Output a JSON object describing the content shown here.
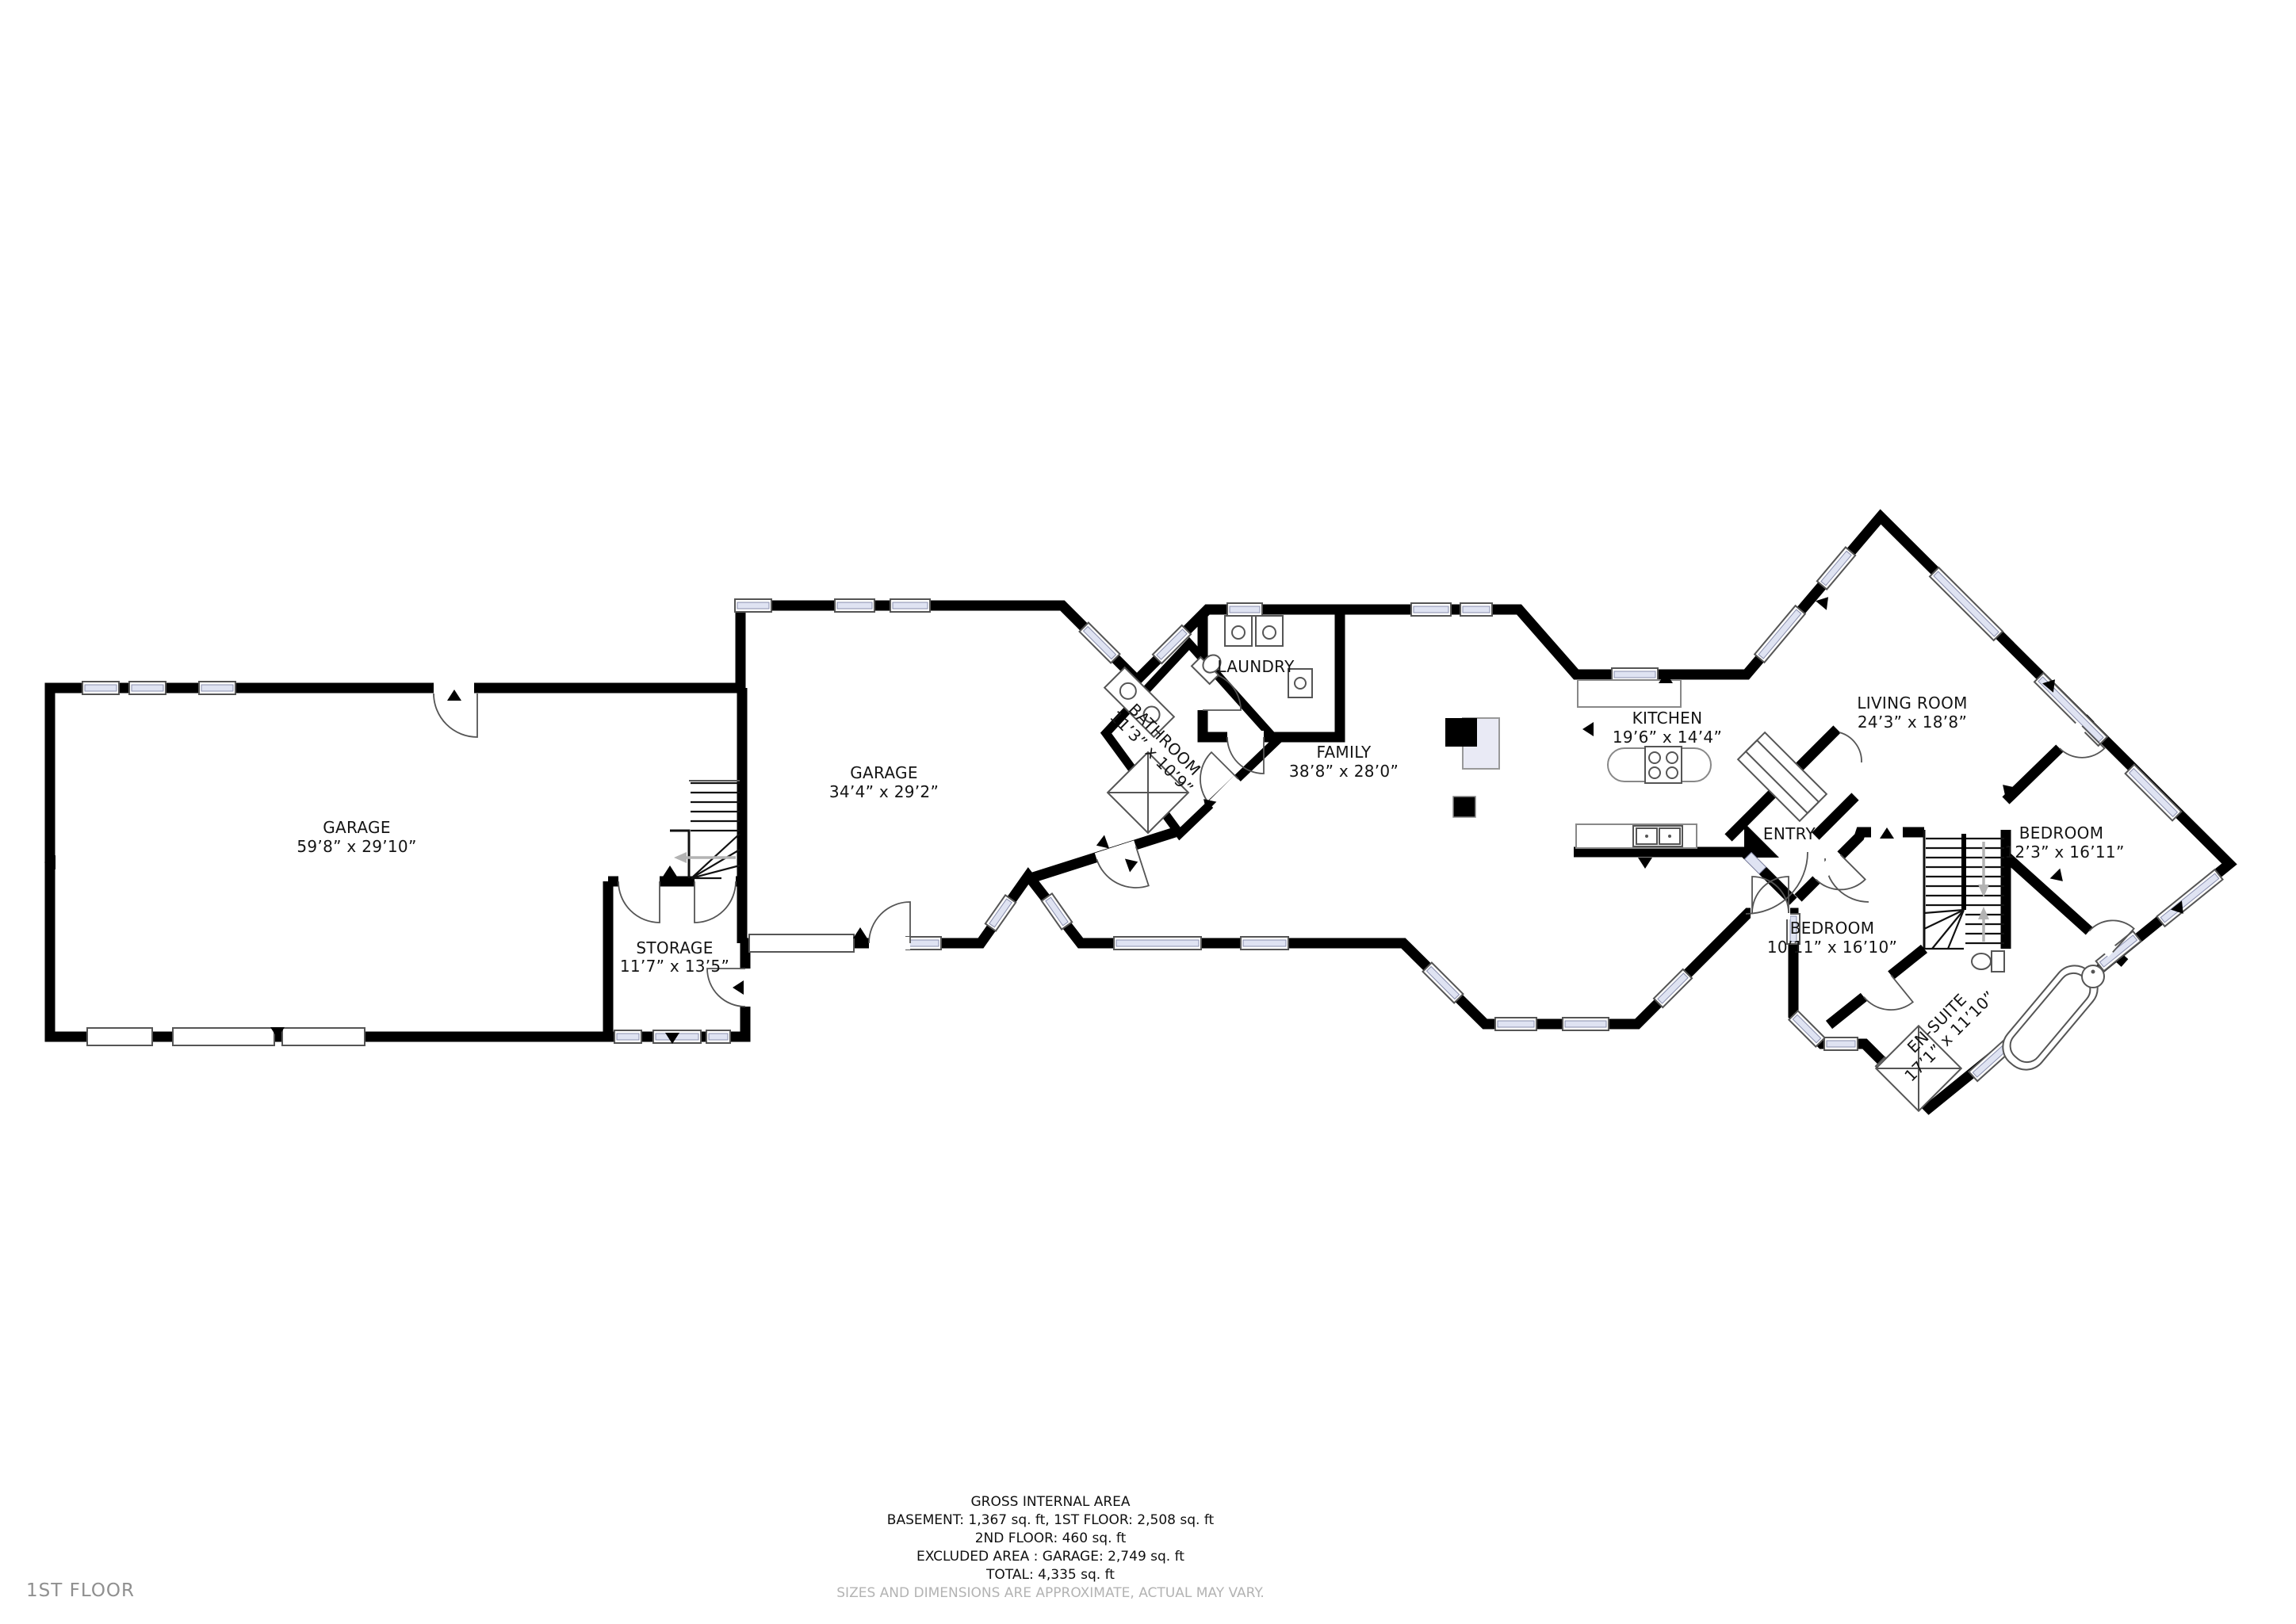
{
  "floor_label": "1ST FLOOR",
  "footer": {
    "title": "GROSS INTERNAL AREA",
    "line_basement_first": "BASEMENT: 1,367 sq. ft, 1ST FLOOR: 2,508 sq. ft",
    "line_second_floor": "2ND FLOOR: 460 sq. ft",
    "line_excluded": "EXCLUDED AREA : GARAGE: 2,749 sq. ft",
    "line_total": "TOTAL: 4,335 sq. ft",
    "disclaimer": "SIZES AND DIMENSIONS ARE APPROXIMATE, ACTUAL MAY VARY."
  },
  "rooms": {
    "garage_main": {
      "name": "GARAGE",
      "dims": "59’8” x 29’10”"
    },
    "storage": {
      "name": "STORAGE",
      "dims": "11’7” x 13’5”"
    },
    "garage_second": {
      "name": "GARAGE",
      "dims": "34’4” x 29’2”"
    },
    "bathroom": {
      "name": "BATHROOM",
      "dims": "11’3” x 10’9”"
    },
    "laundry": {
      "name": "LAUNDRY",
      "dims": ""
    },
    "family": {
      "name": "FAMILY",
      "dims": "38’8” x 28’0”"
    },
    "kitchen": {
      "name": "KITCHEN",
      "dims": "19’6” x 14’4”"
    },
    "entry": {
      "name": "ENTRY",
      "dims": ""
    },
    "living_room": {
      "name": "LIVING ROOM",
      "dims": "24’3” x 18’8”"
    },
    "bedroom_right": {
      "name": "BEDROOM",
      "dims": "12’3” x 16’11”"
    },
    "bedroom_left": {
      "name": "BEDROOM",
      "dims": "10’11” x 16’10”"
    },
    "ensuite": {
      "name": "EN-SUITE",
      "dims": "17’1” x 11’10”"
    }
  },
  "colors": {
    "wall": "#000000",
    "window_glass": "#dfe3f2",
    "fireplace_shade": "#e9eaf5",
    "label_text": "#141414",
    "muted_text": "#b3b3b3",
    "floor_tag_text": "#8f8f8f",
    "stair_arrow": "#b3b3b3"
  }
}
